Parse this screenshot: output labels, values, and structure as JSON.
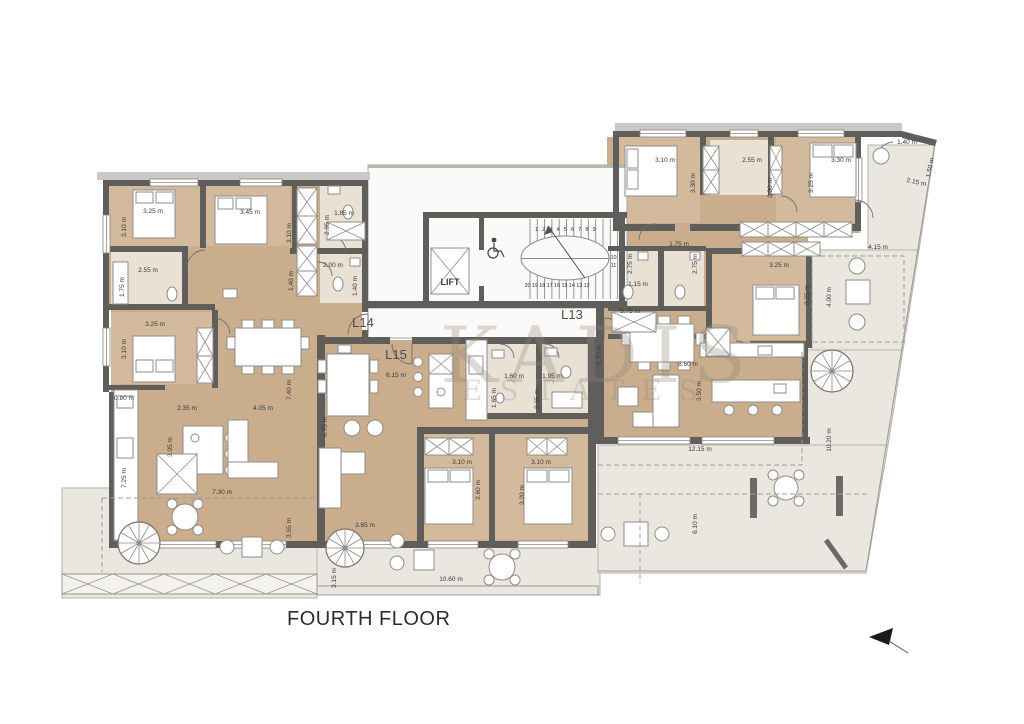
{
  "title": "FOURTH FLOOR",
  "units": [
    {
      "label": "L13"
    },
    {
      "label": "L14"
    },
    {
      "label": "L15"
    }
  ],
  "core": {
    "lift_label": "LIFT",
    "stair_numbers_top": [
      "1",
      "2",
      "3",
      "4",
      "5",
      "6",
      "7",
      "8",
      "9"
    ],
    "stair_numbers_right": [
      "10",
      "11"
    ],
    "stair_numbers_bottom": [
      "20",
      "19",
      "18",
      "17",
      "16",
      "15",
      "14",
      "13",
      "12"
    ]
  },
  "watermark": {
    "line1": "KADIS",
    "line2": "ESTATES"
  },
  "icons": {
    "north_arrow": "left-pointing-arrow",
    "wheelchair": "wheelchair-accessible",
    "lift": "elevator-shaft-cross",
    "spiral_stairs": "spiral-staircase"
  },
  "colors": {
    "wood": "#c9ad8c",
    "bathroom": "#e9e1d4",
    "wall": "#5f5e5b",
    "terrace": "#eae7e1",
    "planter_green": "#8fa574",
    "watermark": "#8d867c"
  },
  "dimensions": [
    {
      "t": "3.25 m",
      "x": 153,
      "y": 213,
      "r": 0
    },
    {
      "t": "3.10 m",
      "x": 126,
      "y": 227,
      "r": -90
    },
    {
      "t": "3.45 m",
      "x": 250,
      "y": 214,
      "r": 0
    },
    {
      "t": "3.10 m",
      "x": 291,
      "y": 233,
      "r": -90
    },
    {
      "t": "1.85 m",
      "x": 344,
      "y": 215,
      "r": 0
    },
    {
      "t": "2.95 m",
      "x": 329,
      "y": 225,
      "r": -90
    },
    {
      "t": "1.40 m",
      "x": 293,
      "y": 281,
      "r": -90
    },
    {
      "t": "2.55 m",
      "x": 148,
      "y": 272,
      "r": 0
    },
    {
      "t": "1.75 m",
      "x": 124,
      "y": 287,
      "r": -90
    },
    {
      "t": "2.00 m",
      "x": 333,
      "y": 267,
      "r": 0
    },
    {
      "t": "1.40 m",
      "x": 357,
      "y": 286,
      "r": -90
    },
    {
      "t": "3.25 m",
      "x": 155,
      "y": 326,
      "r": 0
    },
    {
      "t": "3.10 m",
      "x": 126,
      "y": 349,
      "r": -90
    },
    {
      "t": "2.35 m",
      "x": 187,
      "y": 410,
      "r": 0
    },
    {
      "t": "4.05 m",
      "x": 263,
      "y": 410,
      "r": 0
    },
    {
      "t": "3.05 m",
      "x": 172,
      "y": 447,
      "r": -90
    },
    {
      "t": "7.40 m",
      "x": 291,
      "y": 390,
      "r": -90
    },
    {
      "t": "0.80 m",
      "x": 124,
      "y": 400,
      "r": 0
    },
    {
      "t": "7.25 m",
      "x": 126,
      "y": 478,
      "r": -90
    },
    {
      "t": "7.30 m",
      "x": 222,
      "y": 494,
      "r": 0
    },
    {
      "t": "3.55 m",
      "x": 291,
      "y": 528,
      "r": -90
    },
    {
      "t": "3.85 m",
      "x": 365,
      "y": 527,
      "r": 0
    },
    {
      "t": "3.15 m",
      "x": 336,
      "y": 578,
      "r": -90
    },
    {
      "t": "10.60 m",
      "x": 451,
      "y": 581,
      "r": 0
    },
    {
      "t": "6.15 m",
      "x": 396,
      "y": 377,
      "r": 0
    },
    {
      "t": "6.75 m",
      "x": 327,
      "y": 427,
      "r": -90
    },
    {
      "t": "1.60 m",
      "x": 514,
      "y": 378,
      "r": 0
    },
    {
      "t": "1.95 m",
      "x": 552,
      "y": 378,
      "r": 0
    },
    {
      "t": "1.65 m",
      "x": 496,
      "y": 398,
      "r": -90
    },
    {
      "t": "2.65 m",
      "x": 539,
      "y": 399,
      "r": -90
    },
    {
      "t": "3.10 m",
      "x": 462,
      "y": 464,
      "r": 0
    },
    {
      "t": "3.10 m",
      "x": 541,
      "y": 464,
      "r": 0
    },
    {
      "t": "3.60 m",
      "x": 480,
      "y": 490,
      "r": -90
    },
    {
      "t": "3.20 m",
      "x": 524,
      "y": 495,
      "r": -90
    },
    {
      "t": "3.10 m",
      "x": 665,
      "y": 162,
      "r": 0
    },
    {
      "t": "3.30 m",
      "x": 695,
      "y": 183,
      "r": -90
    },
    {
      "t": "2.55 m",
      "x": 752,
      "y": 162,
      "r": 0
    },
    {
      "t": "2.00 m",
      "x": 772,
      "y": 188,
      "r": -90
    },
    {
      "t": "3.30 m",
      "x": 841,
      "y": 162,
      "r": 0
    },
    {
      "t": "3.25 m",
      "x": 813,
      "y": 183,
      "r": -90
    },
    {
      "t": "1.40 m",
      "x": 907,
      "y": 144,
      "r": 0
    },
    {
      "t": "1.50 m",
      "x": 932,
      "y": 168,
      "r": -78
    },
    {
      "t": "2.15 m",
      "x": 916,
      "y": 184,
      "r": 12
    },
    {
      "t": "1.75 m",
      "x": 679,
      "y": 246,
      "r": 0
    },
    {
      "t": "2.75 m",
      "x": 632,
      "y": 264,
      "r": -90
    },
    {
      "t": "2.75 m",
      "x": 697,
      "y": 264,
      "r": -90
    },
    {
      "t": "1.15 m",
      "x": 638,
      "y": 286,
      "r": 0
    },
    {
      "t": "5.75 m",
      "x": 630,
      "y": 313,
      "r": 0
    },
    {
      "t": "3.25 m",
      "x": 779,
      "y": 267,
      "r": 0
    },
    {
      "t": "3.25 m",
      "x": 809,
      "y": 295,
      "r": -90
    },
    {
      "t": "4.00 m",
      "x": 831,
      "y": 297,
      "r": -90
    },
    {
      "t": "4.15 m",
      "x": 878,
      "y": 249,
      "r": 0
    },
    {
      "t": "5.70 m",
      "x": 601,
      "y": 355,
      "r": -90
    },
    {
      "t": "8.60 m",
      "x": 688,
      "y": 366,
      "r": 0
    },
    {
      "t": "3.50 m",
      "x": 701,
      "y": 391,
      "r": -90
    },
    {
      "t": "12.15 m",
      "x": 700,
      "y": 451,
      "r": 0
    },
    {
      "t": "10.20 m",
      "x": 831,
      "y": 440,
      "r": -90
    },
    {
      "t": "6.10 m",
      "x": 697,
      "y": 524,
      "r": -90
    }
  ]
}
